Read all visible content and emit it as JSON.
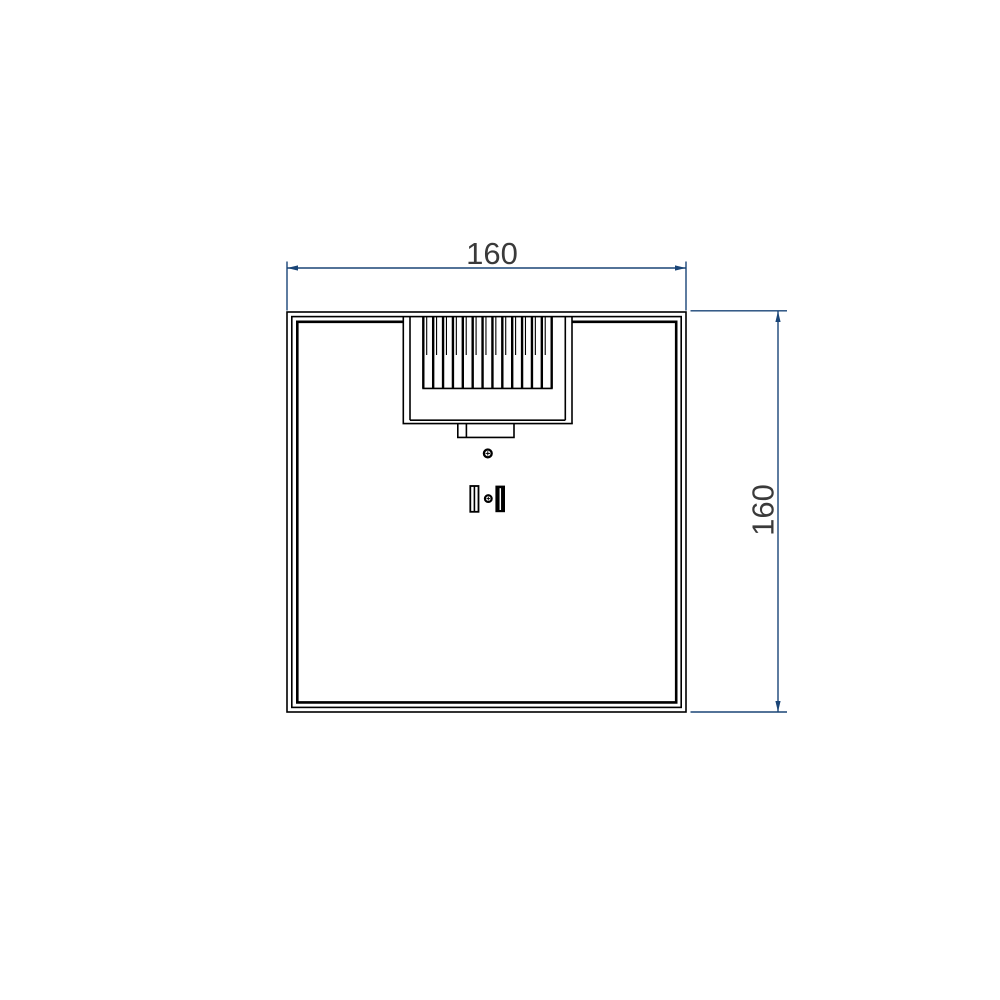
{
  "drawing": {
    "background": "#ffffff",
    "outline_color": "#000000",
    "dimension": {
      "line_color": "#1a4577",
      "text_color": "#3a3a3a",
      "width_label": "160",
      "height_label": "160"
    },
    "features": {
      "fin_count": 14
    }
  }
}
